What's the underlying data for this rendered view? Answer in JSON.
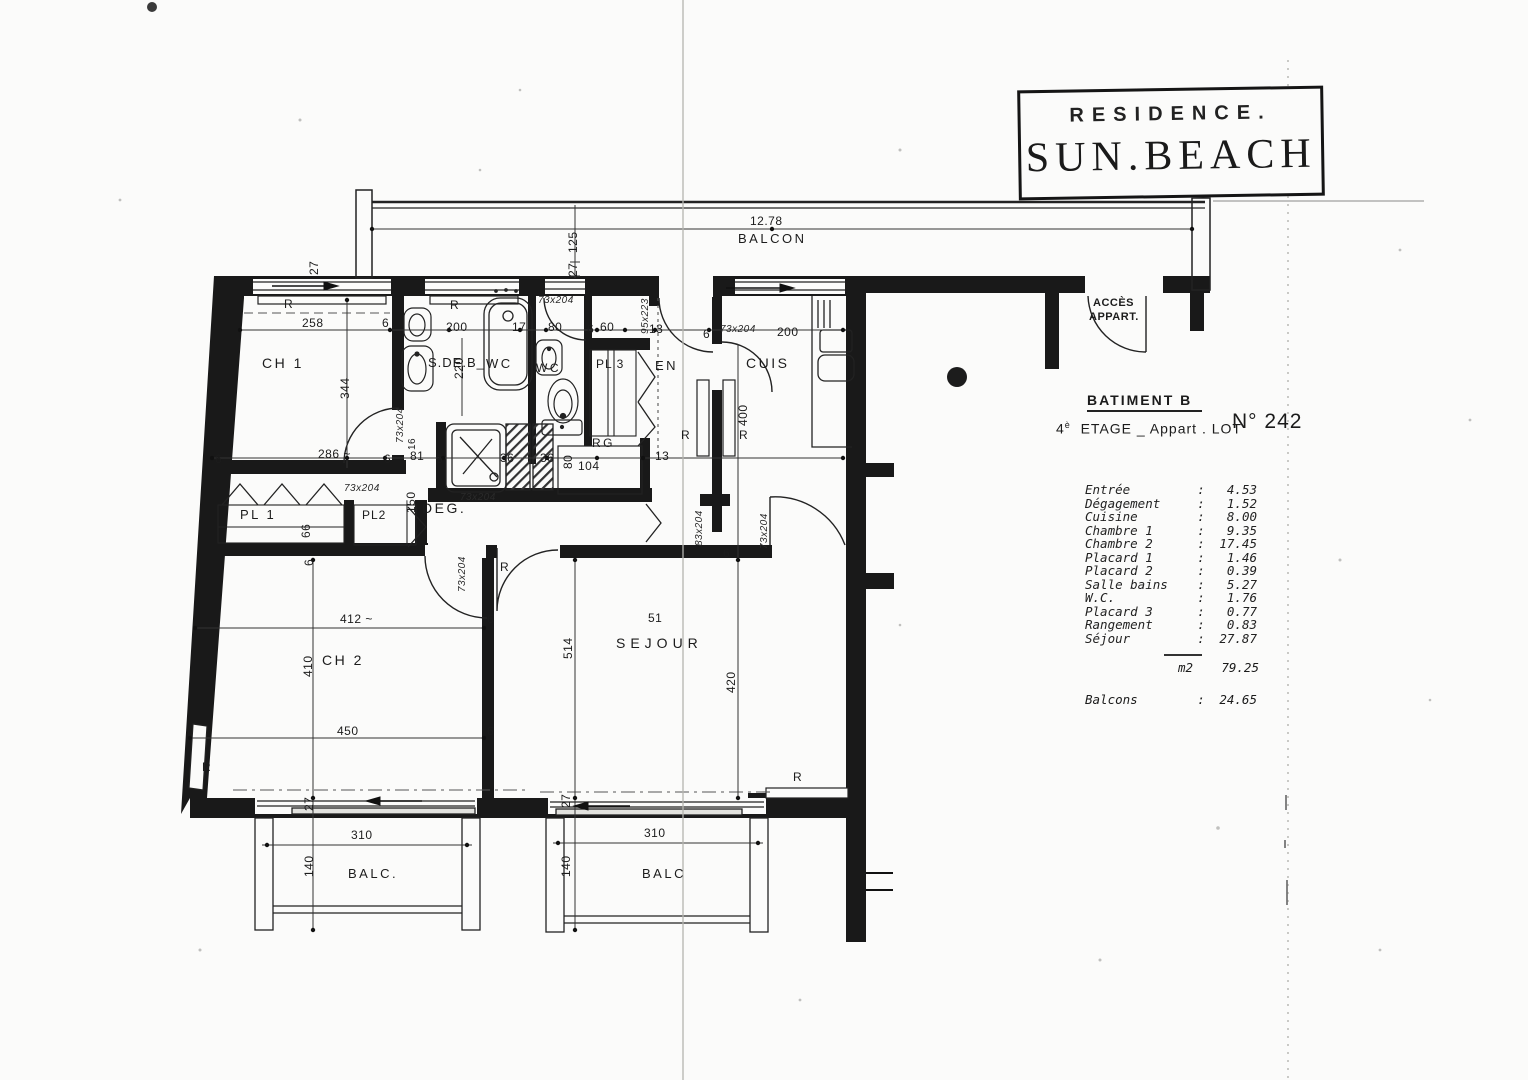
{
  "title_block": {
    "line1": "RESIDENCE.",
    "line2": "SUN.BEACH"
  },
  "info": {
    "batiment": "BATIMENT B",
    "floor_num": "4",
    "floor_sup": "è",
    "floor_text": "ETAGE _ Appart .  LOT",
    "lot_number": "N° 242",
    "colon": ":",
    "rooms": [
      {
        "name": "Entrée",
        "value": "4.53"
      },
      {
        "name": "Dégagement",
        "value": "1.52"
      },
      {
        "name": "Cuisine",
        "value": "8.00"
      },
      {
        "name": "Chambre 1",
        "value": "9.35"
      },
      {
        "name": "Chambre 2",
        "value": "17.45"
      },
      {
        "name": "Placard 1",
        "value": "1.46"
      },
      {
        "name": "Placard 2",
        "value": "0.39"
      },
      {
        "name": "Salle bains",
        "value": "5.27"
      },
      {
        "name": "W.C.",
        "value": "1.76"
      },
      {
        "name": "Placard 3",
        "value": "0.77"
      },
      {
        "name": "Rangement",
        "value": "0.83"
      },
      {
        "name": "Séjour",
        "value": "27.87"
      }
    ],
    "total_unit": "m2",
    "total_value": "79.25",
    "balcons_label": "Balcons",
    "balcons_value": "24.65"
  },
  "plan": {
    "texts": [
      {
        "t": "CH 1"
      },
      {
        "t": "S.DE.B_"
      },
      {
        "t": "WC"
      },
      {
        "t": "WC"
      },
      {
        "t": "PL 3"
      },
      {
        "t": "EN"
      },
      {
        "t": "CUIS"
      },
      {
        "t": "DEG."
      },
      {
        "t": "PL 1"
      },
      {
        "t": "PL2"
      },
      {
        "t": "RG"
      },
      {
        "t": "CH 2"
      },
      {
        "t": "SEJOUR"
      },
      {
        "t": "BALC."
      },
      {
        "t": "BALC"
      },
      {
        "t": "BALCON"
      },
      {
        "t": "ACCÈS"
      },
      {
        "t": "APPART."
      },
      {
        "t": "12.78"
      },
      {
        "t": "125"
      },
      {
        "t": "27"
      },
      {
        "t": "27"
      },
      {
        "t": "258"
      },
      {
        "t": "6"
      },
      {
        "t": "200"
      },
      {
        "t": "17"
      },
      {
        "t": "80"
      },
      {
        "t": "6"
      },
      {
        "t": "60"
      },
      {
        "t": "13"
      },
      {
        "t": "6"
      },
      {
        "t": "73x204"
      },
      {
        "t": "200"
      },
      {
        "t": "95x223"
      },
      {
        "t": "344"
      },
      {
        "t": "286 ~"
      },
      {
        "t": "220"
      },
      {
        "t": "73x204"
      },
      {
        "t": "73x204"
      },
      {
        "t": "16"
      },
      {
        "t": "81"
      },
      {
        "t": "6"
      },
      {
        "t": "6"
      },
      {
        "t": "6"
      },
      {
        "t": "36"
      },
      {
        "t": "36"
      },
      {
        "t": "80"
      },
      {
        "t": "104"
      },
      {
        "t": "13"
      },
      {
        "t": "73x204"
      },
      {
        "t": "150"
      },
      {
        "t": "66"
      },
      {
        "t": "6"
      },
      {
        "t": "73x204"
      },
      {
        "t": "73x204"
      },
      {
        "t": "83x204"
      },
      {
        "t": "73x204"
      },
      {
        "t": "6"
      },
      {
        "t": "400"
      },
      {
        "t": "412 ~"
      },
      {
        "t": "410"
      },
      {
        "t": "450"
      },
      {
        "t": "6"
      },
      {
        "t": "6"
      },
      {
        "t": "514"
      },
      {
        "t": "51"
      },
      {
        "t": "420"
      },
      {
        "t": "27"
      },
      {
        "t": "140"
      },
      {
        "t": "310"
      },
      {
        "t": "27"
      },
      {
        "t": "140"
      },
      {
        "t": "310"
      },
      {
        "t": "R"
      },
      {
        "t": "R"
      },
      {
        "t": "R"
      },
      {
        "t": "R"
      },
      {
        "t": "R"
      },
      {
        "t": "R"
      },
      {
        "t": "R"
      }
    ]
  }
}
